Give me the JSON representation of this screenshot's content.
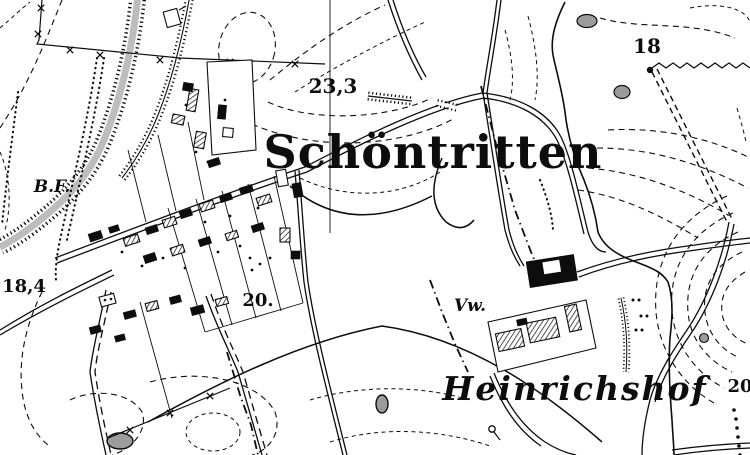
{
  "map": {
    "description": "Historical black-and-white topographic map sheet section",
    "labels": {
      "village": "Schöntritten",
      "estate": "Heinrichshof",
      "vorwerk_abbr": "Vw.",
      "bf_abbr": "B.F.",
      "elev_233": "23,3",
      "elev_18": "18",
      "elev_18_4": "18,4",
      "elev_20_center": "20.",
      "elev_20_edge": "20"
    },
    "colors": {
      "ink": "#0d0d0d",
      "paper": "#ffffff",
      "water_gray": "#bdbdbd",
      "pond_gray": "#9c9c9c"
    }
  }
}
